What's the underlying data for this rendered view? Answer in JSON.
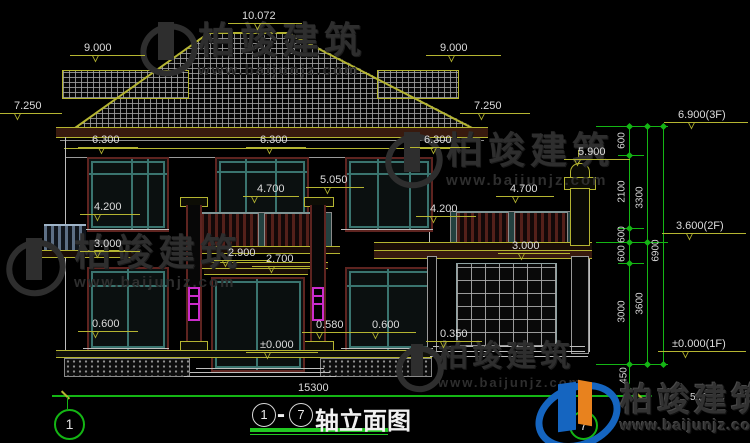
{
  "drawing": {
    "dims": {
      "ridge": "10.072",
      "ridge_left": "9.000",
      "ridge_right": "9.000",
      "eave_left": "7.250",
      "eave_right": "7.250",
      "eave_line_1": "6.300",
      "eave_line_2": "6.300",
      "eave_line_3": "6.300",
      "finial_top": "5.900",
      "column_capital": "5.050",
      "balcony_rail_center": "4.700",
      "terrace_rail_right": "4.700",
      "sill2_left": "4.200",
      "sill2_right": "4.200",
      "slab_left": "3.000",
      "slab_right": "3.000",
      "balcony_slab_top": "2.900",
      "balcony_slab_bottom": "2.700",
      "sill1_left": "0.600",
      "sill1_center": "0.580",
      "sill1_right": "0.600",
      "garage_apron": "0.350",
      "floor_zero": "±0.000",
      "overall_width": "15300"
    },
    "levels": [
      {
        "label": "6.900(3F)"
      },
      {
        "label": "3.600(2F)"
      },
      {
        "label": "±0.000(1F)"
      }
    ],
    "chain": {
      "s600a": "600",
      "s2100": "2100",
      "s3300": "3300",
      "s600b": "600",
      "s600c": "600",
      "s3000": "3000",
      "s3600": "3600",
      "s6900": "6900",
      "s450": "450"
    }
  },
  "title": {
    "axis_from": "1",
    "dash": "-",
    "axis_to": "7",
    "text": "轴立面图"
  },
  "axis_bubbles": {
    "left": "1",
    "right": "7"
  },
  "watermark": {
    "brand": "柏竣建筑",
    "url": "www.baijunjz.com"
  },
  "logo": {
    "brand": "柏竣建筑",
    "url": "www.baijunjz.com"
  },
  "fragment": "5 (立面)",
  "colors": {
    "dim_yellow": "#b5b531",
    "axis_green": "#14b514",
    "window_teal": "#3a746f",
    "frame_maroon": "#5e2420",
    "pipe_magenta": "#cc2ccc",
    "logo_blue": "#1565c0",
    "logo_orange": "#e8821e"
  }
}
